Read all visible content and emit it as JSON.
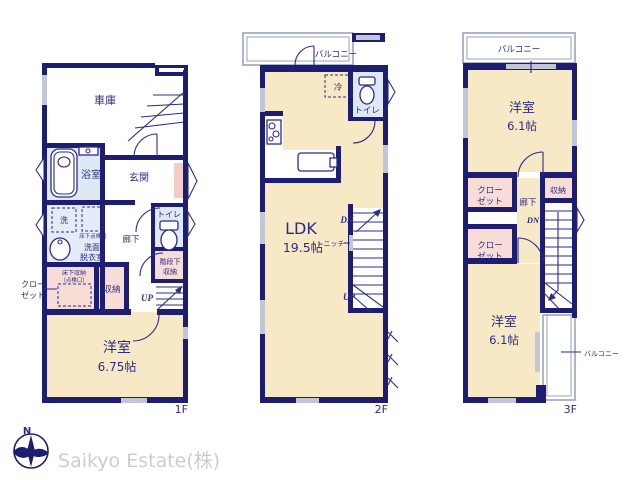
{
  "colors": {
    "wall_navy": "#1d1d72",
    "text_navy": "#2c2c87",
    "room_cream": "#f7e8c6",
    "room_pink": "#f8dcd6",
    "room_blue": "#dfe8f5",
    "entry_mat_pink": "#f2cec7",
    "window_gray": "#c2c6d6",
    "balcony_gray": "#9aa3bd",
    "company_gray": "#cdcdcd"
  },
  "floor1": {
    "label": "1F",
    "garage": "車庫",
    "bathroom": "浴室",
    "entrance": "玄関",
    "washer": "洗",
    "underfloor_hatch": "床下点検口",
    "washroom_line1": "洗面",
    "washroom_line2": "脱衣室",
    "hallway": "廊下",
    "toilet": "トイレ",
    "understair_line1": "階段下",
    "understair_line2": "収納",
    "up": "UP",
    "closet_line1": "クロー",
    "closet_line2": "ゼット",
    "underfloor_storage_line1": "床下収納",
    "underfloor_storage_line2": "（点検口）",
    "storage": "収納",
    "bedroom": "洋室",
    "bedroom_size": "6.75帖"
  },
  "floor2": {
    "label": "2F",
    "balcony": "バルコニー",
    "fridge": "冷",
    "toilet": "トイレ",
    "ldk": "LDK",
    "ldk_size": "19.5帖",
    "niche": "ニッチ",
    "dn": "DN",
    "up": "UP"
  },
  "floor3": {
    "label": "3F",
    "balcony_top": "バルコニー",
    "bedroom_top": "洋室",
    "bedroom_top_size": "6.1帖",
    "closet_a_line1": "クロー",
    "closet_a_line2": "ゼット",
    "hallway": "廊下",
    "storage": "収納",
    "dn": "DN",
    "closet_b_line1": "クロー",
    "closet_b_line2": "ゼット",
    "bedroom_bottom": "洋室",
    "bedroom_bottom_size": "6.1帖",
    "balcony_side": "バルコニー"
  },
  "footer": {
    "compass_north": "N",
    "company": "Saikyo Estate(株)"
  }
}
